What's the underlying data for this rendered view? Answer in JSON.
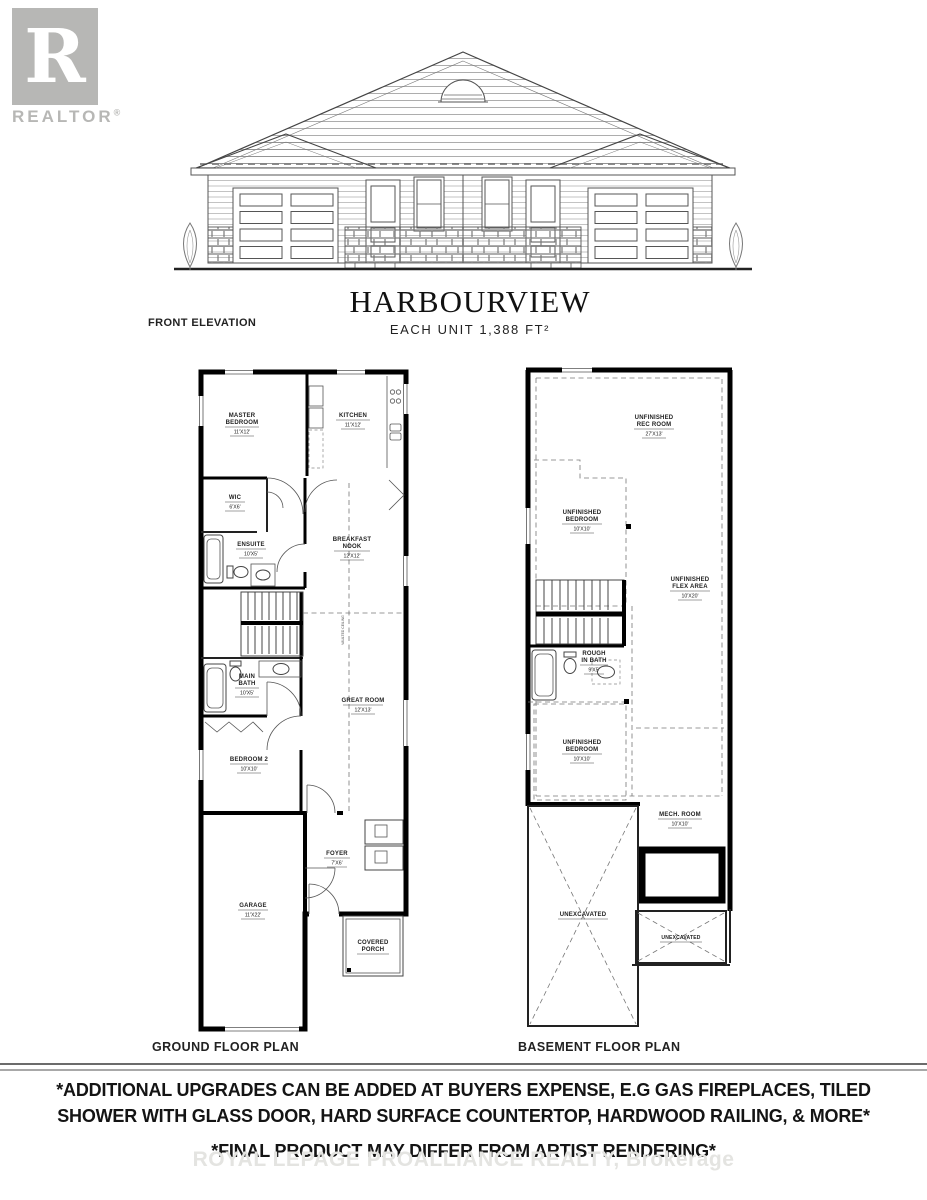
{
  "logo": {
    "letter": "R",
    "wordmark": "REALTOR",
    "registered": "®"
  },
  "elevation": {
    "label": "FRONT ELEVATION"
  },
  "title": {
    "name": "HARBOURVIEW",
    "subtitle": "EACH UNIT 1,388 FT²"
  },
  "ground_floor": {
    "plan_label": "GROUND FLOOR PLAN",
    "vaulted_note": "VAULTED CEILING",
    "rooms": {
      "master": {
        "line1": "MASTER",
        "line2": "BEDROOM",
        "dim": "11'X12'"
      },
      "kitchen": {
        "line1": "KITCHEN",
        "dim": "11'X12'"
      },
      "wic": {
        "line1": "WIC",
        "dim": "6'X6'"
      },
      "ensuite": {
        "line1": "ENSUITE",
        "dim": "10'X5'"
      },
      "breakfast": {
        "line1": "BREAKFAST",
        "line2": "NOOK",
        "dim": "12'X12'"
      },
      "mainbath": {
        "line1": "MAIN",
        "line2": "BATH",
        "dim": "10'X5'"
      },
      "greatroom": {
        "line1": "GREAT ROOM",
        "dim": "12'X13'"
      },
      "bedroom2": {
        "line1": "BEDROOM 2",
        "dim": "10'X10'"
      },
      "garage": {
        "line1": "GARAGE",
        "dim": "11'X22'"
      },
      "foyer": {
        "line1": "FOYER",
        "dim": "7'X6'"
      },
      "porch": {
        "line1": "COVERED",
        "line2": "PORCH"
      }
    }
  },
  "basement": {
    "plan_label": "BASEMENT FLOOR PLAN",
    "rooms": {
      "recroom": {
        "line1": "UNFINISHED",
        "line2": "REC ROOM",
        "dim": "27'X13'"
      },
      "bedroom_upper": {
        "line1": "UNFINISHED",
        "line2": "BEDROOM",
        "dim": "10'X10'"
      },
      "flex": {
        "line1": "UNFINISHED",
        "line2": "FLEX AREA",
        "dim": "10'X20'"
      },
      "roughbath": {
        "line1": "ROUGH",
        "line2": "IN BATH",
        "dim": "9'X5'"
      },
      "bedroom_lower": {
        "line1": "UNFINISHED",
        "line2": "BEDROOM",
        "dim": "10'X10'"
      },
      "mech": {
        "line1": "MECH. ROOM",
        "dim": "10'X10'"
      },
      "unexcavated_left": {
        "line1": "UNEXCAVATED"
      },
      "unexcavated_right": {
        "line1": "UNEXCAVATED"
      }
    }
  },
  "footer": {
    "disclaimer_line1": "*ADDITIONAL UPGRADES CAN BE ADDED AT BUYERS EXPENSE, E.G GAS FIREPLACES, TILED",
    "disclaimer_line2": "SHOWER WITH GLASS DOOR, HARD SURFACE COUNTERTOP, HARDWOOD RAILING, & MORE*",
    "disclaimer_line3": "*FINAL PRODUCT MAY DIFFER FROM ARTIST RENDERING*",
    "watermark": "ROYAL LEPAGE PROALLIANCE REALTY, Brokerage"
  }
}
